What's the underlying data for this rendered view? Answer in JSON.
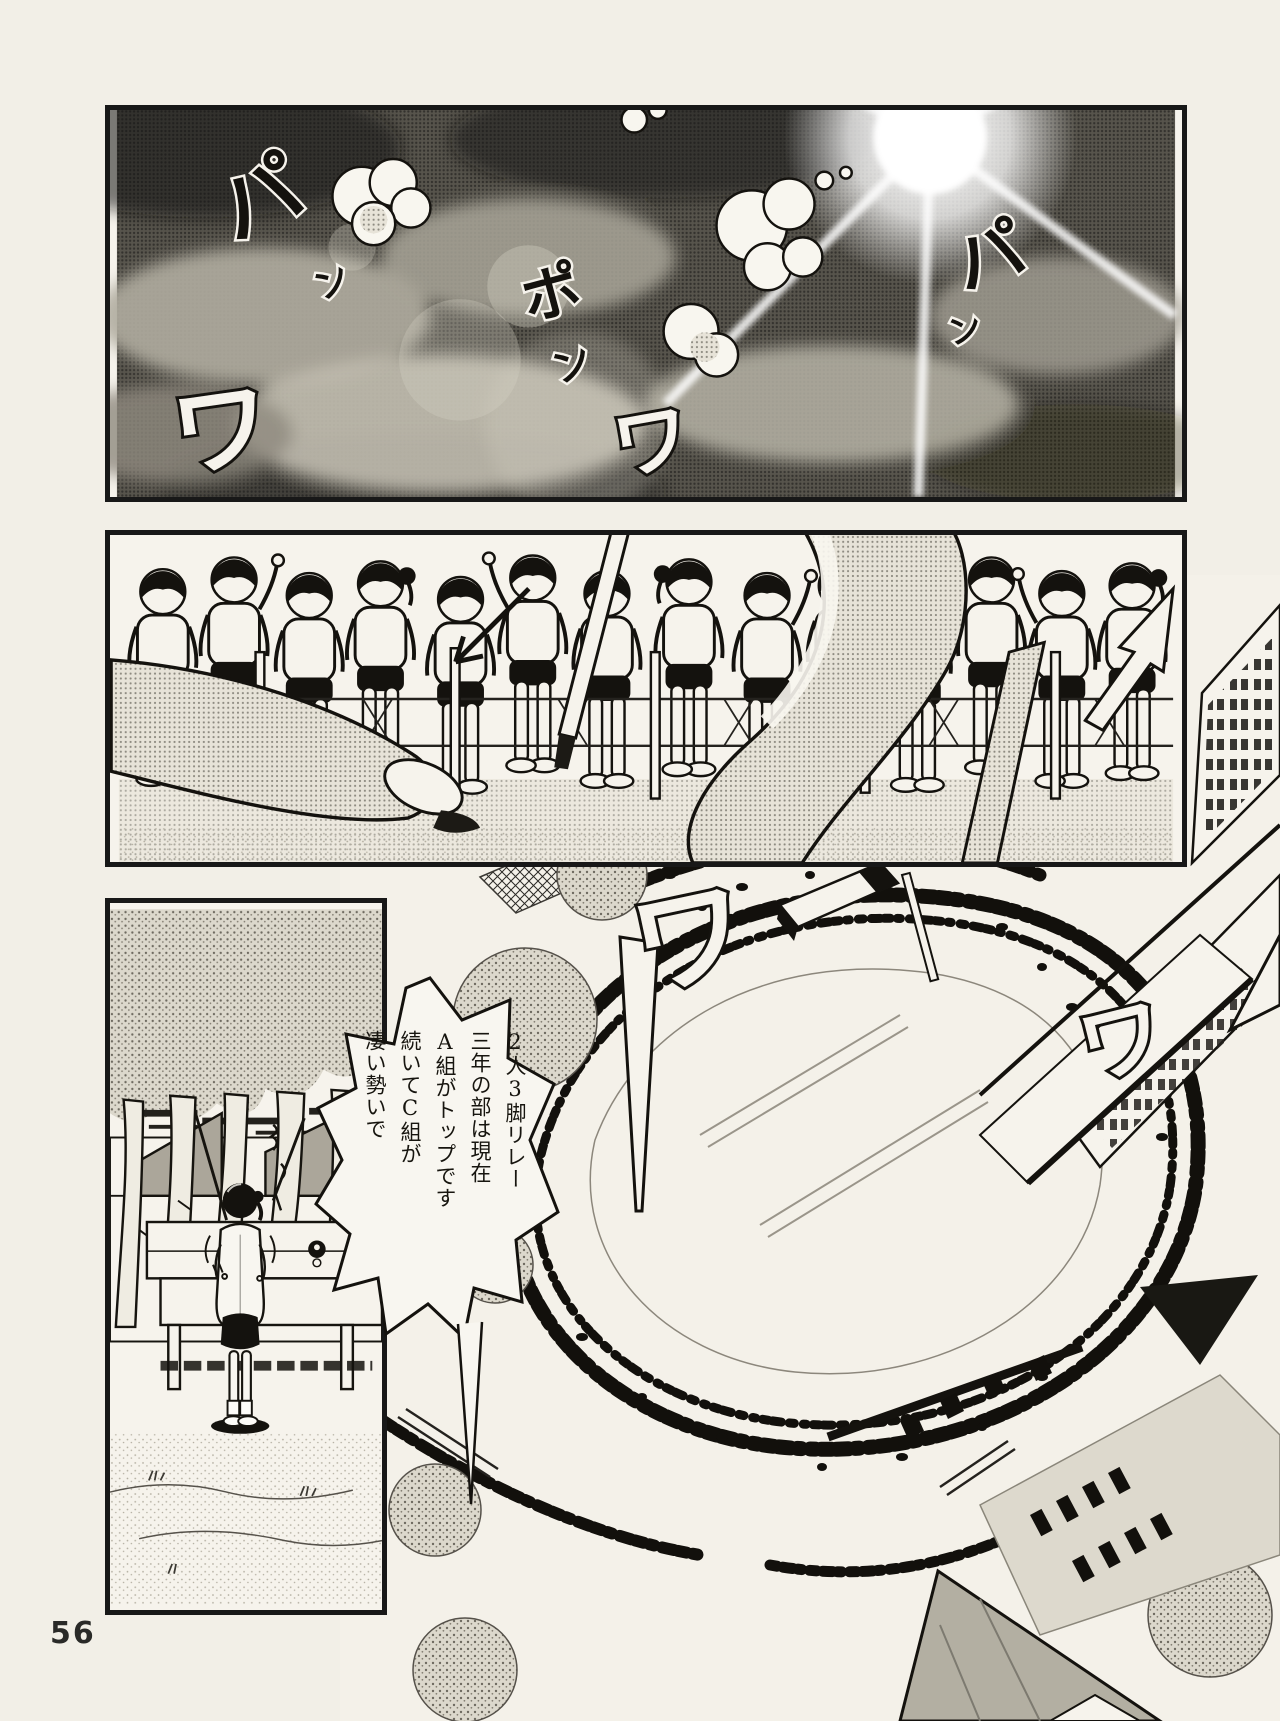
{
  "page": {
    "number": "56"
  },
  "colors": {
    "paper": "#f2efe7",
    "ink": "#181818"
  },
  "bubble": {
    "lines": [
      "2人3脚リレー",
      "三年の部は現在",
      "A組がトップです",
      "続いてC組が",
      "凄い勢いで"
    ]
  },
  "sfx": {
    "sky_pa_left": "パ",
    "sky_n_left": "ン",
    "sky_po": "ポ",
    "sky_n_mid": "ン",
    "sky_pa_right": "パ",
    "sky_n_right": "ン",
    "sky_wa_left": "ワ",
    "sky_wa_right": "ワ",
    "field_wa_1": "ワ",
    "field_wa_2": "ワ"
  }
}
